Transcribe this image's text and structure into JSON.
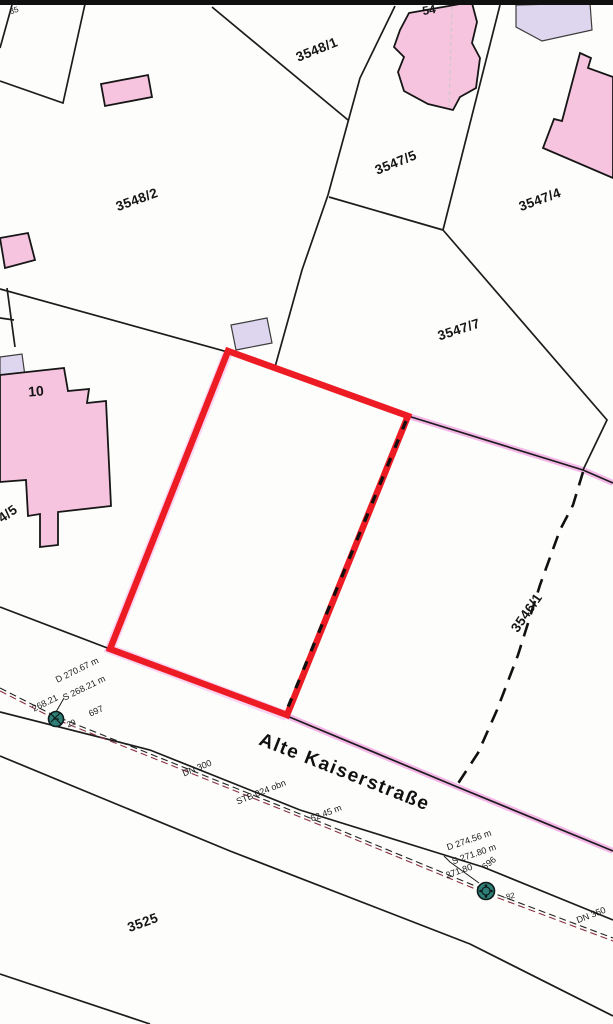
{
  "map": {
    "street": {
      "name": "Alte Kaiserstraße"
    },
    "parcel_labels": {
      "p3548_2": "3548/2",
      "p3548_1": "3548/1",
      "p3547_5": "3547/5",
      "p3547_4": "3547/4",
      "p3547_7": "3547/7",
      "p3546_1": "3546/1",
      "p3525": "3525",
      "partial_left": "4/5",
      "partial_top": "35"
    },
    "house_numbers": {
      "h10": "10",
      "h54": "54"
    },
    "sewer": {
      "manhole_left": {
        "depth": "D 270.67 m",
        "invert": "S 268.21 m",
        "elevation": "268.21",
        "point": "29",
        "id": "697"
      },
      "pipe_main": {
        "diameter": "DN 300",
        "material": "STB 024 obn",
        "length": "62.45 m"
      },
      "manhole_right": {
        "depth": "D 274.56 m",
        "invert": "S 271.80 m",
        "id": "696",
        "elevation": "271.80",
        "point": "-82",
        "diameter": "DN 350"
      }
    },
    "colors": {
      "building_pink": "#f7c4df",
      "building_lavender": "#ded6ef",
      "parcel_line": "#1c1c1c",
      "highlight_red": "#ec1b24",
      "highlight_pink": "#f3aae4",
      "highlight_pink_soft": "#f8c9ef",
      "sewer_line_red": "#8a3040",
      "manhole_teal": "#2e7f78",
      "paper": "#fdfdfc"
    }
  }
}
